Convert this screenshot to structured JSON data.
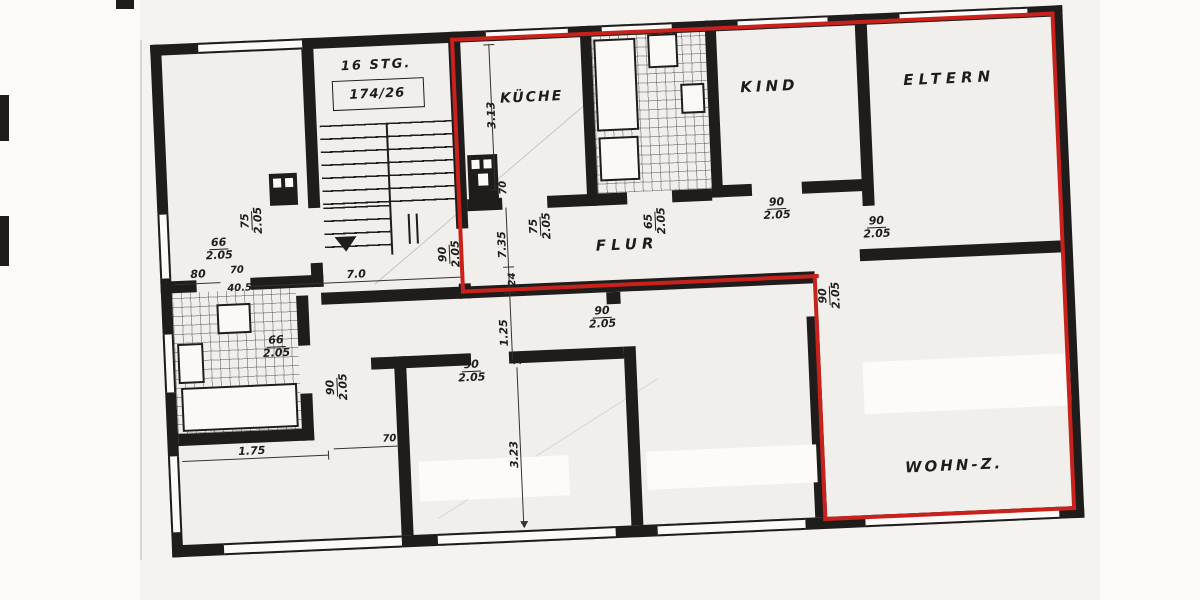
{
  "scan": {
    "paper_color": "#f1efeb",
    "ink_color": "#1e1d1b",
    "highlight_color": "#c9211c"
  },
  "staircase": {
    "label": "16 STG.",
    "number": "174/26"
  },
  "rooms": {
    "kueche": {
      "label": "KÜCHE"
    },
    "kind": {
      "label": "KIND"
    },
    "eltern": {
      "label": "ELTERN"
    },
    "flur": {
      "label": "FLUR"
    },
    "wohnzimmer": {
      "label": "WOHN-Z."
    }
  },
  "door_dims": [
    {
      "num": "75",
      "den": "2.05"
    },
    {
      "num": "66",
      "den": "2.05"
    },
    {
      "num": "90",
      "den": "2.05"
    },
    {
      "num": "75",
      "den": "2.05"
    },
    {
      "num": "65",
      "den": "2.05"
    },
    {
      "num": "90",
      "den": "2.05"
    },
    {
      "num": "90",
      "den": "2.05"
    },
    {
      "num": "90",
      "den": "2.05"
    },
    {
      "num": "90",
      "den": "2.05"
    },
    {
      "num": "90",
      "den": "2.05"
    },
    {
      "num": "90",
      "den": "2.05"
    },
    {
      "num": "66",
      "den": "2.05"
    }
  ],
  "measurements": [
    {
      "text": "80"
    },
    {
      "text": "70"
    },
    {
      "text": "40.5"
    },
    {
      "text": "7.0"
    },
    {
      "text": "3.13"
    },
    {
      "text": "70"
    },
    {
      "text": "7.35"
    },
    {
      "text": "24"
    },
    {
      "text": "1.25"
    },
    {
      "text": "70"
    },
    {
      "text": "3.23"
    },
    {
      "text": "1.75"
    },
    {
      "text": "70"
    }
  ]
}
